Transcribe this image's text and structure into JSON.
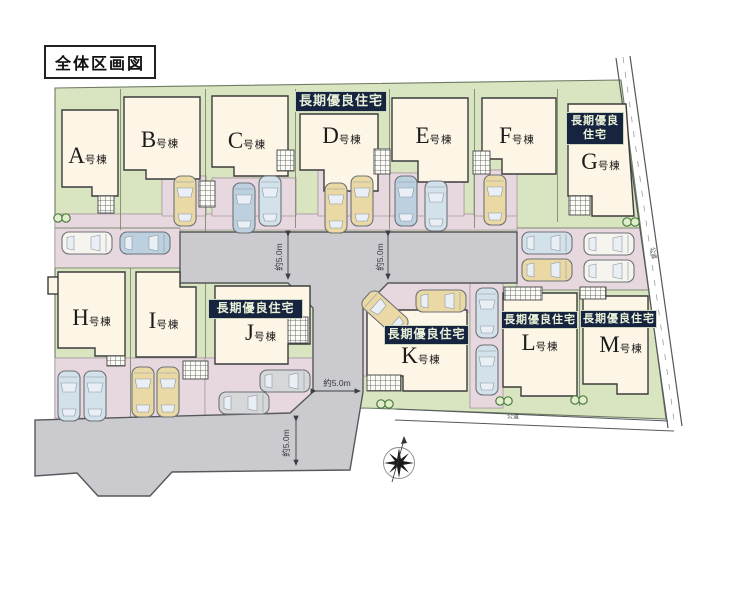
{
  "title": "全体区画図",
  "badge_text": "長期優良住宅",
  "buildings": [
    {
      "name": "A",
      "suffix": "号棟",
      "x": 88,
      "y": 156
    },
    {
      "name": "B",
      "suffix": "号棟",
      "x": 160,
      "y": 140
    },
    {
      "name": "C",
      "suffix": "号棟",
      "x": 247,
      "y": 141
    },
    {
      "name": "D",
      "suffix": "号棟",
      "x": 342,
      "y": 136
    },
    {
      "name": "E",
      "suffix": "号棟",
      "x": 434,
      "y": 136
    },
    {
      "name": "F",
      "suffix": "号棟",
      "x": 517,
      "y": 136
    },
    {
      "name": "G",
      "suffix": "号棟",
      "x": 601,
      "y": 162
    },
    {
      "name": "H",
      "suffix": "号棟",
      "x": 92,
      "y": 318
    },
    {
      "name": "I",
      "suffix": "号棟",
      "x": 164,
      "y": 321
    },
    {
      "name": "J",
      "suffix": "号棟",
      "x": 261,
      "y": 333
    },
    {
      "name": "K",
      "suffix": "号棟",
      "x": 421,
      "y": 356
    },
    {
      "name": "L",
      "suffix": "号棟",
      "x": 540,
      "y": 343
    },
    {
      "name": "M",
      "suffix": "号棟",
      "x": 621,
      "y": 345
    }
  ],
  "badges": [
    {
      "for": "D",
      "lines": [
        "長期優良住宅"
      ],
      "x": 295,
      "y": 91,
      "w": 92,
      "fs": 13
    },
    {
      "for": "G",
      "lines": [
        "長期優良",
        "住宅"
      ],
      "x": 566,
      "y": 112,
      "w": 58,
      "fs": 11
    },
    {
      "for": "J",
      "lines": [
        "長期優良住宅"
      ],
      "x": 208,
      "y": 299,
      "w": 95,
      "fs": 12
    },
    {
      "for": "K",
      "lines": [
        "長期優良住宅"
      ],
      "x": 384,
      "y": 325,
      "w": 85,
      "fs": 12
    },
    {
      "for": "L",
      "lines": [
        "長期優良住宅"
      ],
      "x": 501,
      "y": 311,
      "w": 77,
      "fs": 11
    },
    {
      "for": "M",
      "lines": [
        "長期優良住宅"
      ],
      "x": 580,
      "y": 310,
      "w": 77,
      "fs": 11
    }
  ],
  "dimensions": [
    {
      "text": "約5.0m",
      "x": 279,
      "y": 257,
      "rot": -90
    },
    {
      "text": "約5.0m",
      "x": 380,
      "y": 257,
      "rot": -90
    },
    {
      "text": "約5.0m",
      "x": 337,
      "y": 383,
      "rot": 0
    },
    {
      "text": "約5.0m",
      "x": 286,
      "y": 443,
      "rot": -90
    }
  ],
  "road_labels": [
    {
      "text": "公道",
      "x": 654,
      "y": 253,
      "rot": 80
    },
    {
      "text": "公道",
      "x": 513,
      "y": 416,
      "rot": 2
    }
  ],
  "trees": [
    {
      "x": 62,
      "y": 218
    },
    {
      "x": 631,
      "y": 222
    },
    {
      "x": 385,
      "y": 404
    },
    {
      "x": 504,
      "y": 401
    },
    {
      "x": 579,
      "y": 400
    }
  ],
  "cars": [
    {
      "x": 185,
      "y": 201,
      "rot": 0,
      "c": "tan"
    },
    {
      "x": 244,
      "y": 208,
      "rot": 0,
      "c": "blue"
    },
    {
      "x": 270,
      "y": 201,
      "rot": 0,
      "c": "lightblue"
    },
    {
      "x": 336,
      "y": 208,
      "rot": 0,
      "c": "tan"
    },
    {
      "x": 362,
      "y": 201,
      "rot": 0,
      "c": "tan"
    },
    {
      "x": 406,
      "y": 201,
      "rot": 0,
      "c": "blue"
    },
    {
      "x": 436,
      "y": 206,
      "rot": 0,
      "c": "lightblue"
    },
    {
      "x": 495,
      "y": 200,
      "rot": 0,
      "c": "tan"
    },
    {
      "x": 87,
      "y": 243,
      "rot": 90,
      "c": "white"
    },
    {
      "x": 145,
      "y": 243,
      "rot": 90,
      "c": "blue"
    },
    {
      "x": 547,
      "y": 243,
      "rot": 90,
      "c": "lightblue"
    },
    {
      "x": 609,
      "y": 244,
      "rot": 90,
      "c": "white"
    },
    {
      "x": 547,
      "y": 270,
      "rot": 90,
      "c": "tan"
    },
    {
      "x": 609,
      "y": 271,
      "rot": 90,
      "c": "white"
    },
    {
      "x": 385,
      "y": 313,
      "rot": -48,
      "c": "tan"
    },
    {
      "x": 441,
      "y": 301,
      "rot": 90,
      "c": "tan"
    },
    {
      "x": 487,
      "y": 313,
      "rot": 0,
      "c": "lightblue"
    },
    {
      "x": 487,
      "y": 370,
      "rot": 0,
      "c": "lightblue"
    },
    {
      "x": 69,
      "y": 396,
      "rot": 0,
      "c": "lightblue"
    },
    {
      "x": 95,
      "y": 396,
      "rot": 0,
      "c": "lightblue"
    },
    {
      "x": 143,
      "y": 392,
      "rot": 0,
      "c": "tan"
    },
    {
      "x": 168,
      "y": 392,
      "rot": 0,
      "c": "tan"
    },
    {
      "x": 285,
      "y": 381,
      "rot": 90,
      "c": "gray"
    },
    {
      "x": 244,
      "y": 403,
      "rot": 90,
      "c": "gray"
    }
  ],
  "colors": {
    "lot_green": "#d9e5c0",
    "parking_pink": "#e6d8de",
    "road_gray": "#cbcbcf",
    "building_cream": "#fdf6e6",
    "badge_navy": "#172440",
    "badge_text": "#e9f1d8",
    "car_tan": "#ead9a4",
    "car_blue": "#bcd0e0",
    "car_lightblue": "#d3e1ea",
    "car_gray": "#d5d7d9",
    "car_white": "#f6f4ee"
  }
}
